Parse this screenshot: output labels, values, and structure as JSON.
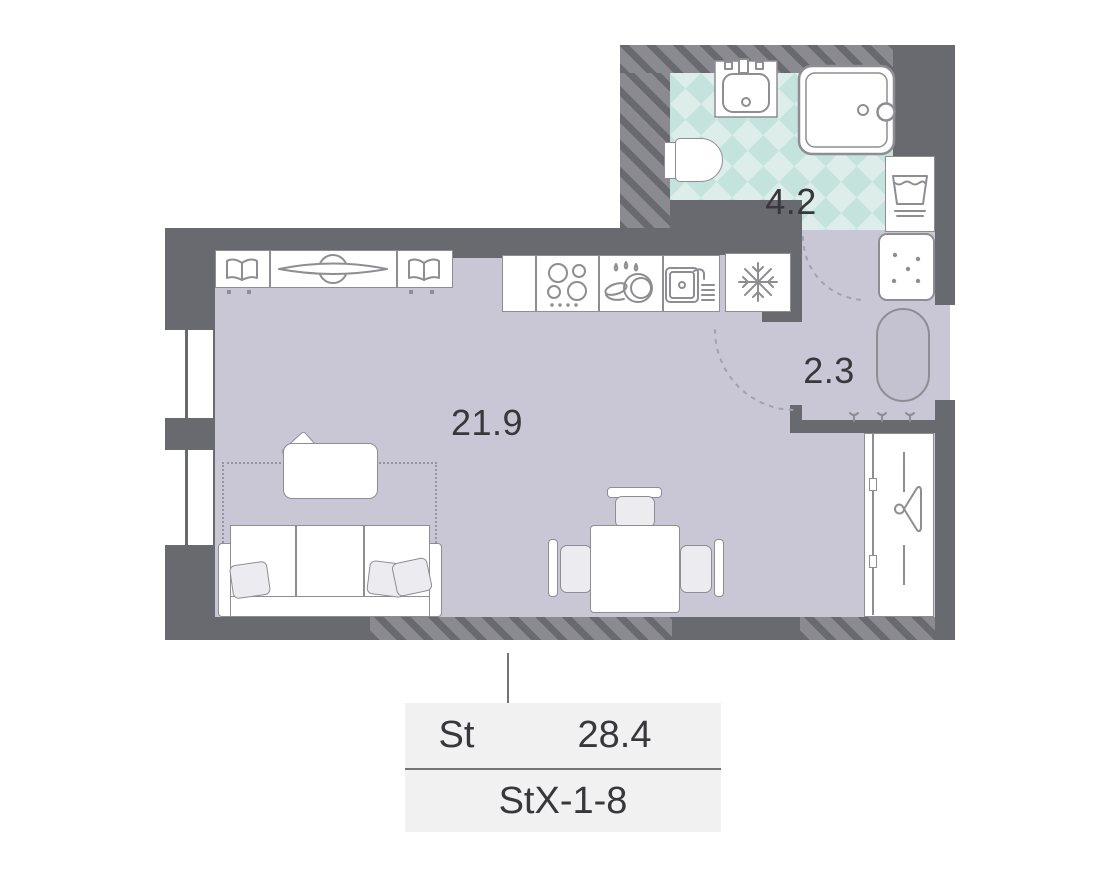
{
  "rooms": {
    "living_kitchen": {
      "area": "21.9"
    },
    "hallway": {
      "area": "2.3"
    },
    "bathroom": {
      "area": "4.2"
    }
  },
  "legend": {
    "unit_type": "St",
    "total_area": "28.4",
    "layout_code": "StX-1-8"
  },
  "icons": [
    "wardrobe-icon",
    "tv-icon",
    "stove-icon",
    "dishwasher-icon",
    "kitchen-sink-icon",
    "fridge-snowflake-icon",
    "washer-icon",
    "bath-sink-icon",
    "shower-icon",
    "toilet-icon",
    "hanger-icon",
    "coat-hooks-icon",
    "shaft-dots-icon"
  ],
  "colors": {
    "wall": "#696970",
    "hatch": "#8a8a90",
    "floor": "#c9c7d6",
    "tile_light": "#dcedea",
    "tile_dark": "#c5e3dd",
    "stroke": "#8d8d93",
    "text": "#37373c",
    "legend_bg": "#f1f1f2",
    "legend_line": "#737378",
    "arc": "#a3a1b1",
    "ottoman": "#c4c2d1"
  }
}
